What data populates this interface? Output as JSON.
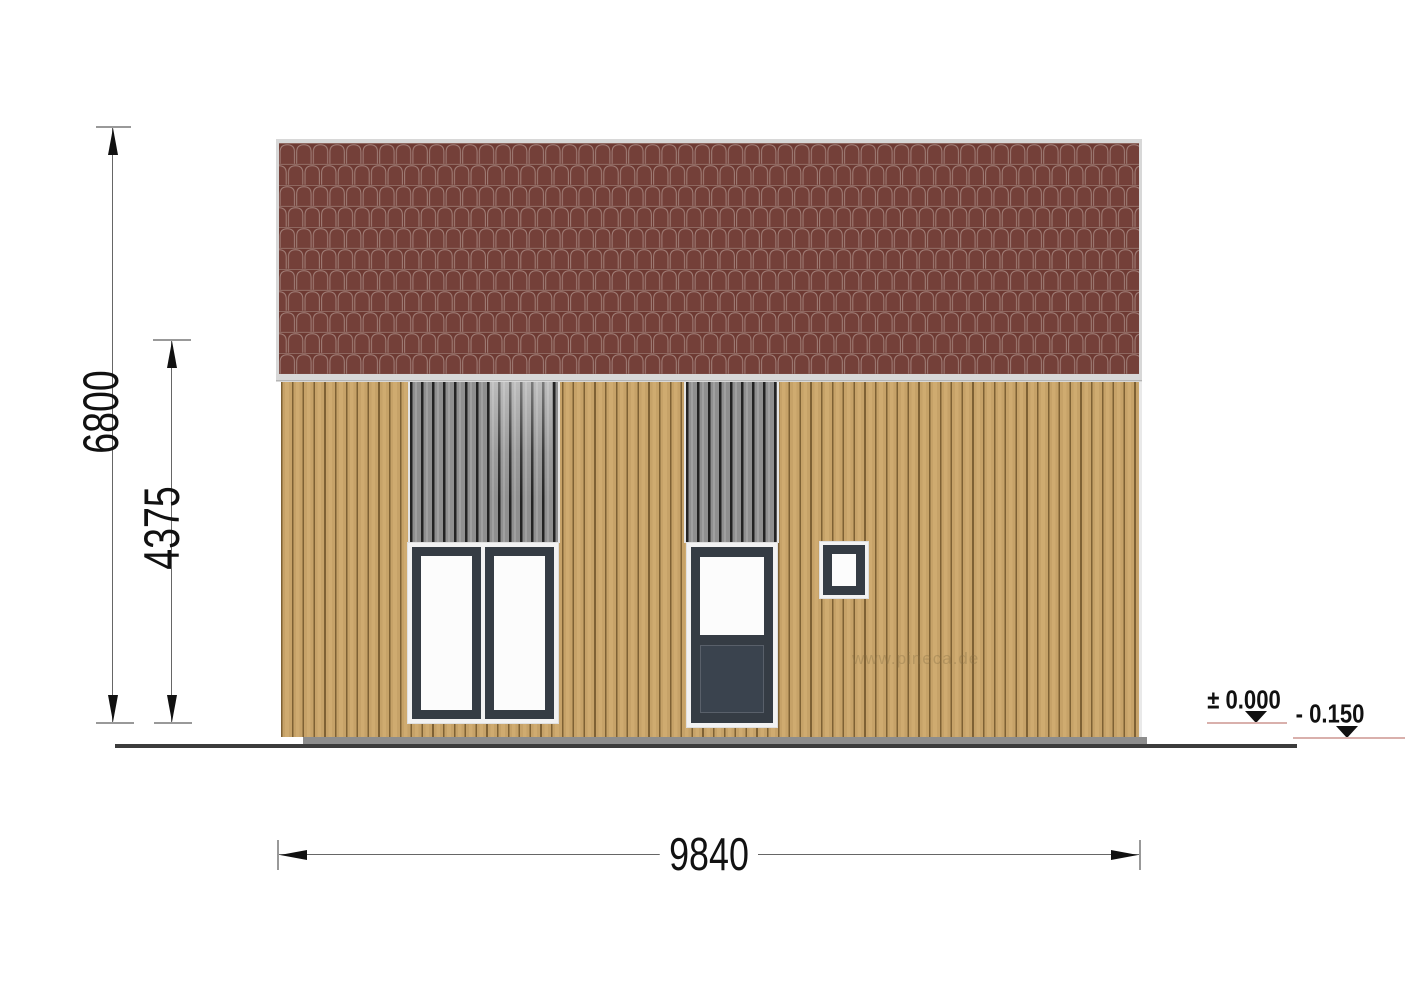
{
  "dimensions": {
    "total_height": "6800",
    "wall_height": "4375",
    "total_width": "9840"
  },
  "levels": {
    "floor_level": "± 0.000",
    "ground_level": "- 0.150"
  },
  "watermark": "www.pineca.de",
  "colors": {
    "roof_tile": "#6e3a33",
    "roof_tile_line": "#a3817a",
    "roof_trim": "#d8d8d8",
    "wall_board": "#c6a268",
    "wall_gap": "#7e6134",
    "panel_gray": "#8f8f8f",
    "panel_gap": "#232323",
    "frame_dark": "#353c44",
    "door_panel": "#3a434e",
    "trim_white": "#f2f2f2",
    "plinth_gray": "#8d8d8d",
    "ground_line": "#3c3c3c",
    "level_line": "#d9b0ac",
    "dimension_text": "#111111"
  }
}
